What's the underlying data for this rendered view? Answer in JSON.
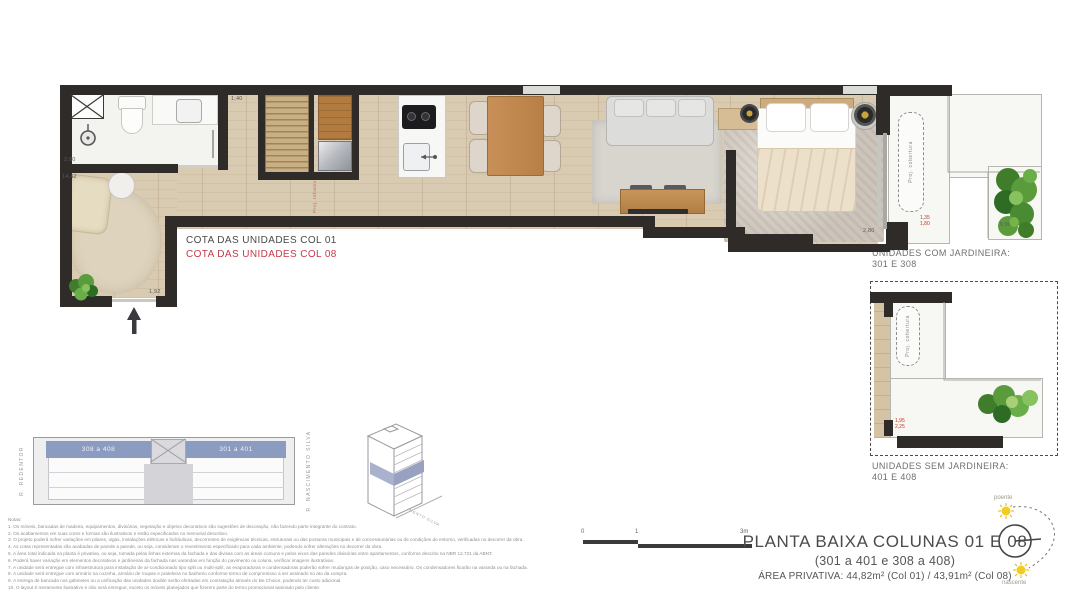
{
  "colors": {
    "wall": "#2f2b28",
    "wood": "#d9cab2",
    "terrace": "#f7f7f3",
    "keyplan_blue": "#8c9cc0",
    "accent_red": "#c43a4b",
    "plant_green": "#4a8a33",
    "sun_yellow": "#f2cc1f"
  },
  "plan": {
    "cota_col01": "COTA DAS UNIDADES COL 01",
    "cota_col08": "COTA DAS UNIDADES COL 08",
    "proj_cobertura": "Proj. cobertura",
    "proj_rebaixo": "Proj. rebaixo",
    "dims": {
      "bath_height": "2,80",
      "total_length": "14,42",
      "entry_width": "1,92",
      "hall_width": "1,40",
      "bedroom_width": "2,80",
      "balc1_a": "1,35",
      "balc1_b": "1,80",
      "balc1_c": "0,95",
      "balc2_a": "1,95",
      "balc2_b": "2,25"
    }
  },
  "jardineira": {
    "with_label": "UNIDADES COM JARDINEIRA:",
    "with_units": "301 E 308",
    "without_label": "UNIDADES SEM JARDINEIRA:",
    "without_units": "401 E 408"
  },
  "keyplan": {
    "street_left": "R. REDENTOR",
    "street_side": "R. NASCIMENTO SILVA",
    "unit_left": "308 a 408",
    "unit_right": "301 a 401"
  },
  "scalebar": {
    "t0": "0",
    "t1": "1",
    "t3": "3m"
  },
  "titleblock": {
    "title": "PLANTA BAIXA COLUNAS 01 E 08",
    "subtitle": "(301 a 401 e 308 a 408)",
    "area": "ÁREA PRIVATIVA: 44,82m² (Col 01) / 43,91m² (Col 08)"
  },
  "compass": {
    "top": "poente",
    "bottom": "nascente"
  },
  "notes": {
    "header": "Notas:",
    "lines": [
      "1. Os móveis, bancadas de madeira, equipamentos, divisórias, vegetação e objetos decorativos são sugestões de decoração, não fazendo parte integrante do contrato.",
      "2. Os acabamentos em suas cores e formas são ilustrativos e estão especificados no memorial descritivo.",
      "3. O projeto poderá sofrer variações em pilares, vigas, instalações elétricas e hidráulicas, decorrentes de exigências técnicas, estruturais ou das posturas municipais e de concessionárias ou de condições do entorno, verificadas no decorrer da obra.",
      "4. As cotas representadas são acabadas de parede a parede, ou seja, consideram o revestimento especificado para cada ambiente, podendo sofrer alterações no decorrer da obra.",
      "5. A área total indicada na planta é privativa, ou seja, tomada pelas linhas externas da fachada e das divisas com as áreas comuns e pelos eixos das paredes divisórias entre apartamentos, conforme descrito na NBR 12.721 da ABNT.",
      "6. Poderá haver variação em elementos decorativos e jardineiras da fachada nas varandas em função do pavimento ou coluna, verificar imagens ilustrativas.",
      "7. A unidade será entregue com infraestrutura para instalação de ar-condicionado tipo split ou multi-split, as evaporadoras e condensadoras poderão sofrer mudanças de posição, caso necessário. Os condensadores ficarão na varanda ou na fachada.",
      "8. A unidade será entregue com armário na cozinha, armário de roupas e prateleira no banheiro conforme termo de compromisso a ser assinado no ato da compra.",
      "9. A entrega de bancada nos gabinetes ou a unificação das unidades double serão ofertadas em contratação através do Be.Choice, podendo ter custo adicional.",
      "10. O layout é meramente ilustrativo e não será entregue, exceto os móveis planejados que fizerem parte do termo promocional assinado pelo cliente."
    ]
  }
}
